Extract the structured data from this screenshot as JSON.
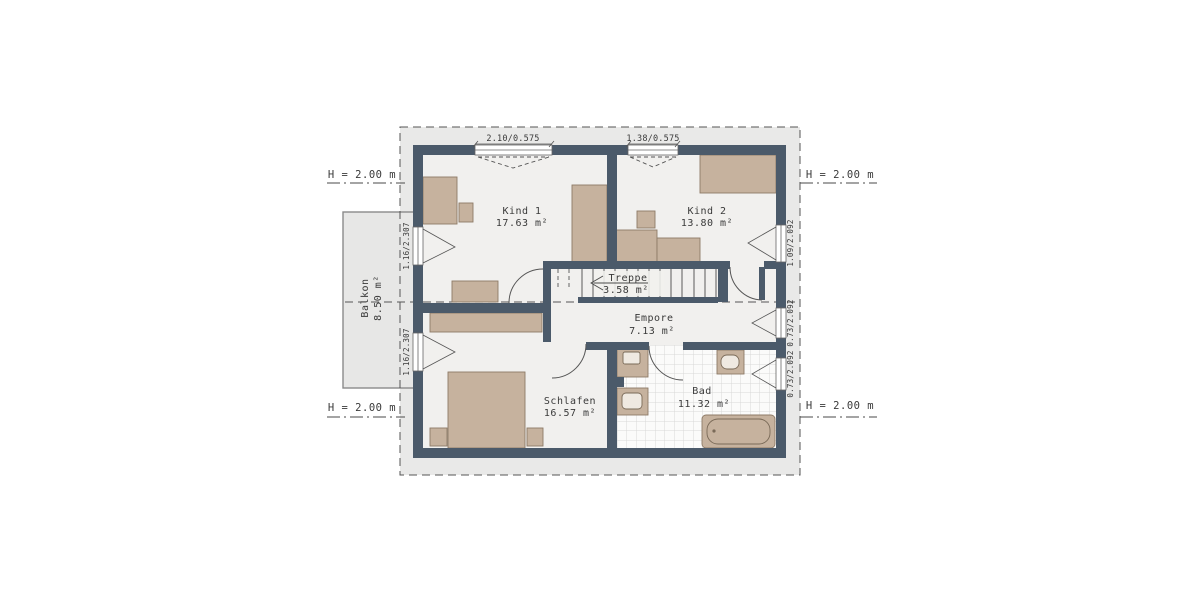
{
  "plan": {
    "rooms": [
      {
        "name": "Kind 1",
        "area": "17.63 m²"
      },
      {
        "name": "Kind 2",
        "area": "13.80 m²"
      },
      {
        "name": "Treppe",
        "area": "3.58 m²"
      },
      {
        "name": "Empore",
        "area": "7.13 m²"
      },
      {
        "name": "Schlafen",
        "area": "16.57 m²"
      },
      {
        "name": "Bad",
        "area": "11.32 m²"
      },
      {
        "name": "Balkon",
        "area": "8.50 m²"
      }
    ],
    "dims": {
      "top1": "2.10/0.575",
      "top2": "1.38/0.575",
      "left1": "1.16/2.307",
      "left2": "1.16/2.307",
      "right1": "1.09/2.092",
      "right2": "0.73/2.092",
      "right3": "0.73/2.092"
    },
    "height_marks": {
      "top_left": "H = 2.00 m",
      "top_right": "H = 2.00 m",
      "bottom_left": "H = 2.00 m",
      "bottom_right": "H = 2.00 m"
    },
    "colors": {
      "wall": "#4b5a6a",
      "furniture": "#c6b29e",
      "floor": "#f1f0ee",
      "roof_area": "#e9e9e8",
      "balcony": "#e7e7e6",
      "tile_base": "#fbfbfa",
      "tile_line": "#d8d8d8",
      "line": "#4a4a4a"
    }
  }
}
